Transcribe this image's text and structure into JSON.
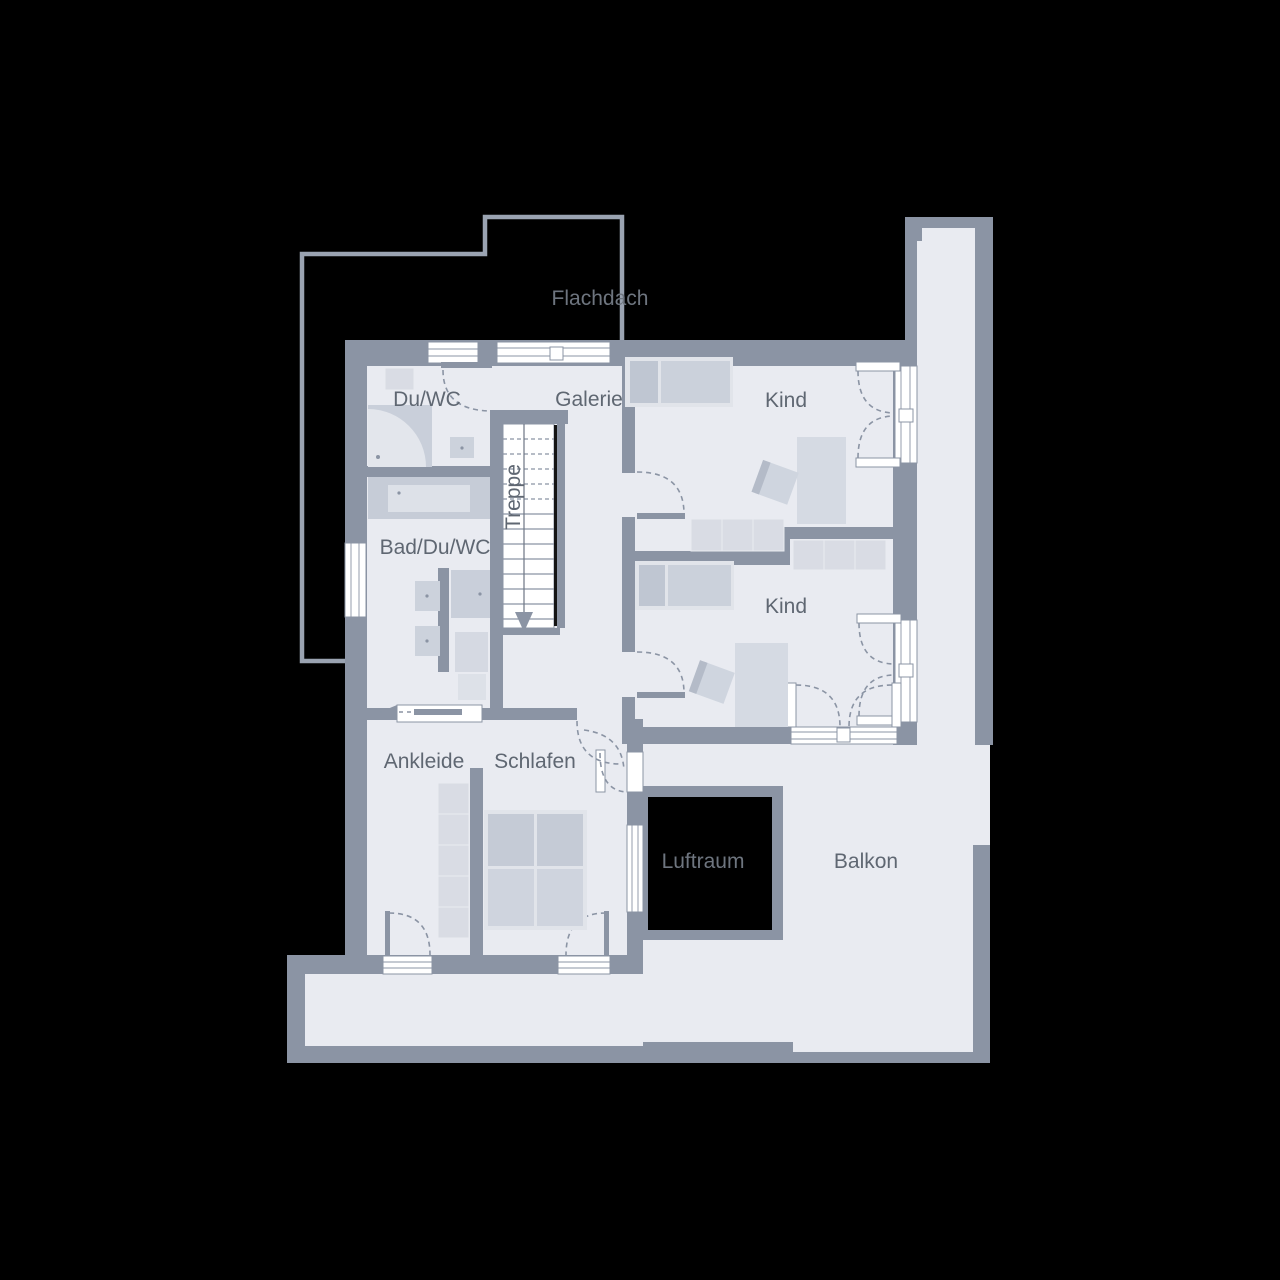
{
  "plan": {
    "labels": {
      "flachdach": "Flachdach",
      "duwc": "Du/WC",
      "galerie": "Galerie",
      "kind1": "Kind",
      "badduwc": "Bad/Du/WC",
      "treppe": "Treppe",
      "kind2": "Kind",
      "ankleide": "Ankleide",
      "schlafen": "Schlafen",
      "luftraum": "Luftraum",
      "balkon": "Balkon"
    }
  },
  "colors": {
    "background": "#000000",
    "wall": "#8b94a4",
    "outline": "#9aa3b1",
    "floor": "#e9ebf1",
    "window": "#ffffff",
    "furniture_light": "#d9dce4",
    "furniture_mid": "#ccd2dc",
    "furniture_dark": "#bfc6d2",
    "bed_frame": "#e1e4ea",
    "label": "#5f6772",
    "label_on_black": "#6e757f",
    "luftraum_fill": "#000000",
    "stair_rail": "#141414"
  }
}
